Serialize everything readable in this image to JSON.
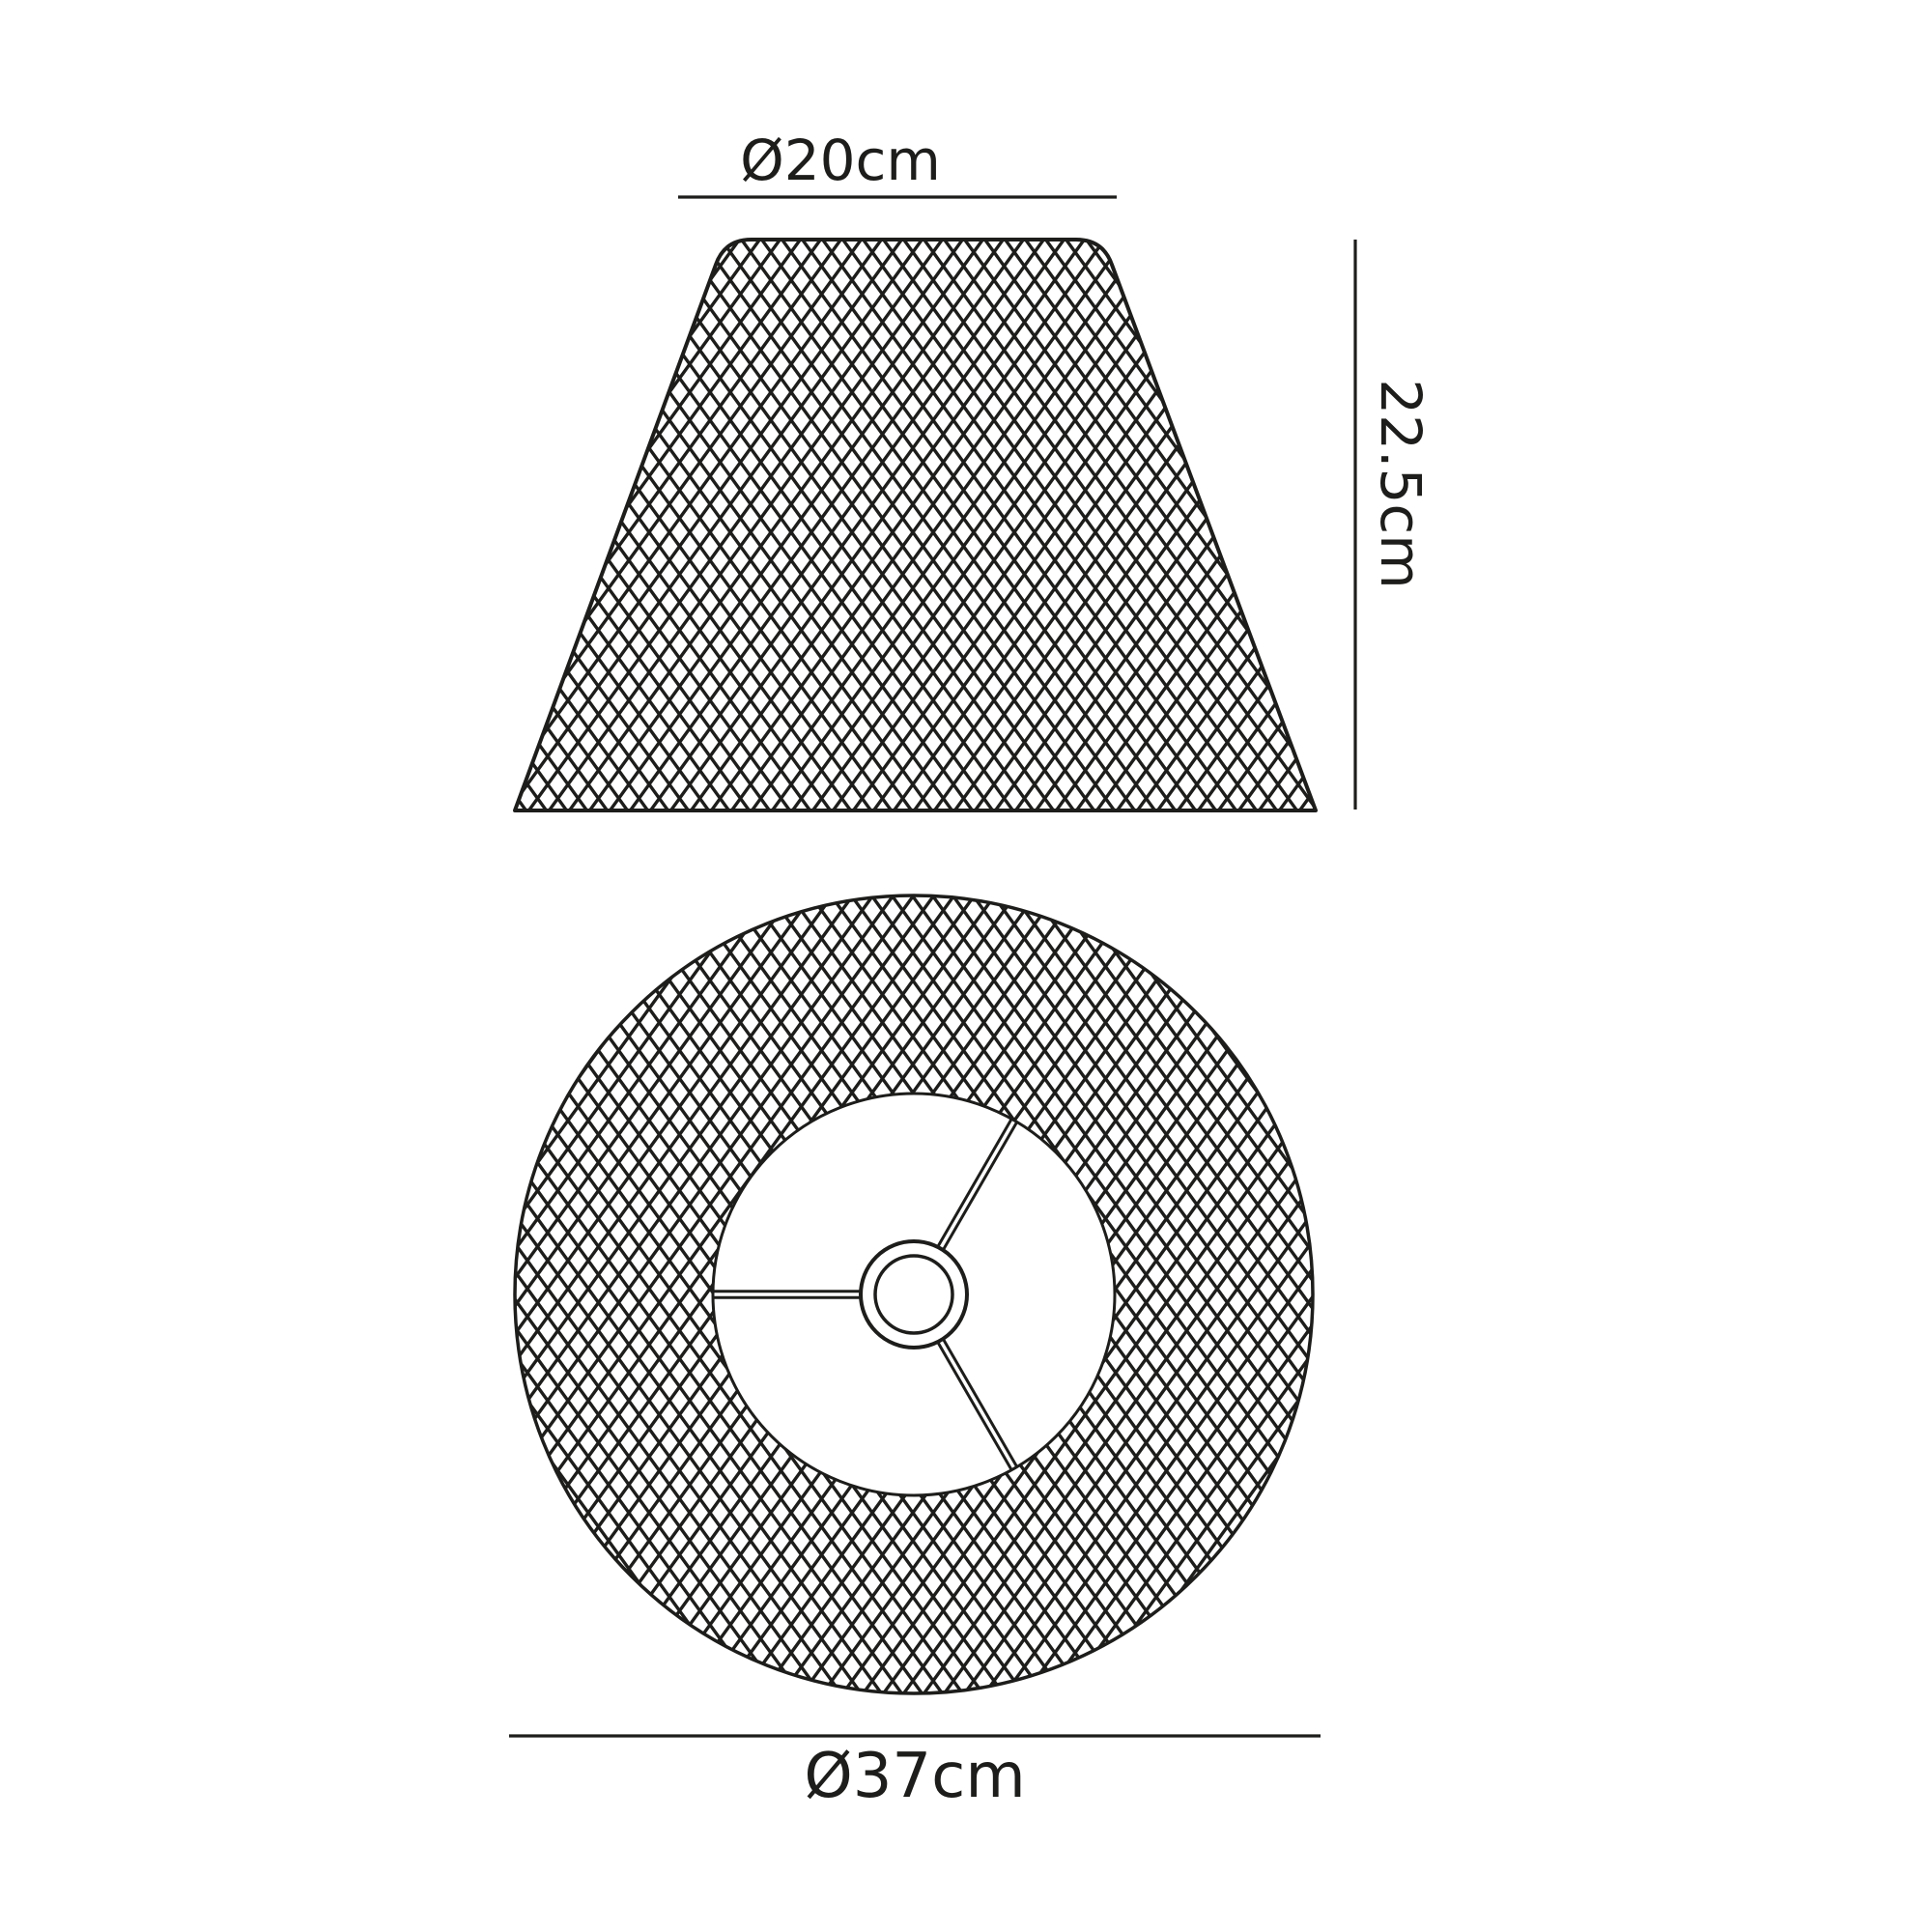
{
  "diagram": {
    "labels": {
      "top_diameter": "Ø20cm",
      "height": "22.5cm",
      "bottom_diameter": "Ø37cm"
    },
    "colors": {
      "line": "#1d1d1b",
      "background": "#ffffff"
    }
  }
}
